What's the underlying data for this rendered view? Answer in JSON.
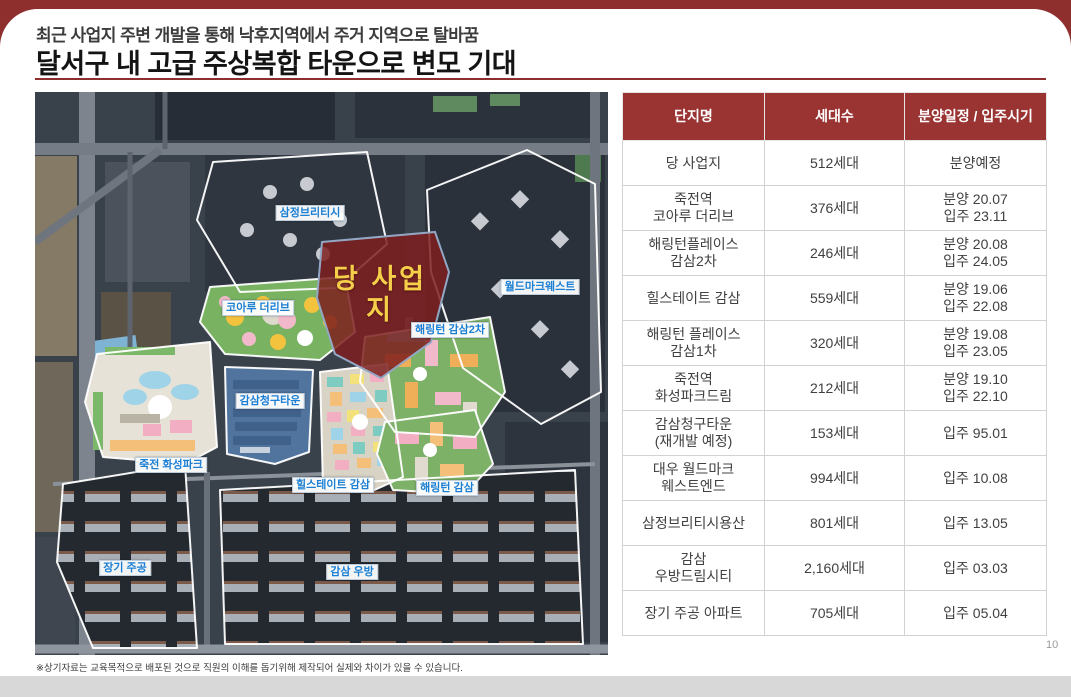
{
  "slide": {
    "kicker": "최근 사업지 주변 개발을 통해 낙후지역에서 주거 지역으로 탈바꿈",
    "title": "달서구 내 고급 주상복합 타운으로 변모 기대",
    "footnote": "※상기자료는 교육목적으로 배포된 것으로 직원의 이해를 돕기위해 제작되어 실제와 차이가 있을 수 있습니다.",
    "page_number": "10"
  },
  "colors": {
    "accent_maroon": "#8E2F2E",
    "table_header_bg": "#9A3433",
    "map_label_blue": "#1B7FD4",
    "site_polygon_red": "#7E1F1F",
    "site_label_yellow": "#F6CF4A"
  },
  "map": {
    "site_label": "당 사업\n지",
    "labels": [
      {
        "id": "samjeong-brities",
        "text": "삼정브리티시",
        "x": 275,
        "y": 121
      },
      {
        "id": "worldmark-west",
        "text": "월드마크웨스트",
        "x": 505,
        "y": 195
      },
      {
        "id": "koaru-the-live",
        "text": "코아루 더리브",
        "x": 223,
        "y": 216
      },
      {
        "id": "harrington-gamsam-2cha",
        "text": "해링턴 감삼2차",
        "x": 415,
        "y": 238
      },
      {
        "id": "gamsam-cheonggu-town",
        "text": "감삼청구타운",
        "x": 235,
        "y": 309
      },
      {
        "id": "jukjeon-hwaseong-park",
        "text": "죽전 화성파크",
        "x": 136,
        "y": 373
      },
      {
        "id": "hillstate-gamsam",
        "text": "힐스테이트 감삼",
        "x": 298,
        "y": 393
      },
      {
        "id": "harrington-gamsam",
        "text": "해링턴 감삼",
        "x": 412,
        "y": 396
      },
      {
        "id": "janggi-jugong",
        "text": "장기 주공",
        "x": 90,
        "y": 476
      },
      {
        "id": "gamsam-ubang",
        "text": "감삼 우방",
        "x": 317,
        "y": 480
      }
    ]
  },
  "table": {
    "headers": [
      "단지명",
      "세대수",
      "분양일정 / 입주시기"
    ],
    "rows": [
      {
        "name": "당 사업지",
        "units": "512세대",
        "schedule": "분양예정"
      },
      {
        "name": "죽전역\n코아루 더리브",
        "units": "376세대",
        "schedule": "분양 20.07\n입주 23.11"
      },
      {
        "name": "해링턴플레이스\n감삼2차",
        "units": "246세대",
        "schedule": "분양 20.08\n입주 24.05"
      },
      {
        "name": "힐스테이트 감삼",
        "units": "559세대",
        "schedule": "분양 19.06\n입주 22.08"
      },
      {
        "name": "해링턴 플레이스\n감삼1차",
        "units": "320세대",
        "schedule": "분양 19.08\n입주 23.05"
      },
      {
        "name": "죽전역\n화성파크드림",
        "units": "212세대",
        "schedule": "분양 19.10\n입주 22.10"
      },
      {
        "name": "감삼청구타운\n(재개발 예정)",
        "units": "153세대",
        "schedule": "입주 95.01"
      },
      {
        "name": "대우 월드마크\n웨스트엔드",
        "units": "994세대",
        "schedule": "입주 10.08"
      },
      {
        "name": "삼정브리티시용산",
        "units": "801세대",
        "schedule": "입주 13.05"
      },
      {
        "name": "감삼\n우방드림시티",
        "units": "2,160세대",
        "schedule": "입주 03.03"
      },
      {
        "name": "장기 주공 아파트",
        "units": "705세대",
        "schedule": "입주 05.04"
      }
    ]
  }
}
